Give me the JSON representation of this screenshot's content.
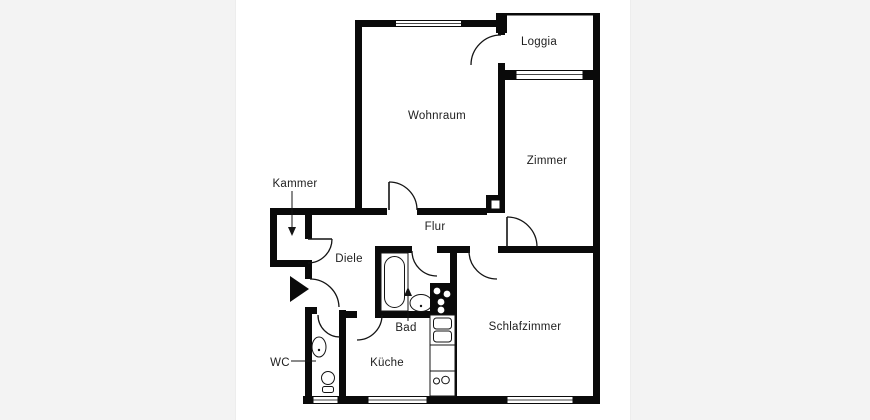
{
  "title": "Grundriss Wohnung (floor plan)",
  "colors": {
    "wall": "#0a0a0a",
    "canvas": "#ffffff",
    "side_panels": "#f3f3f3"
  },
  "rooms": [
    {
      "id": "loggia",
      "label": "Loggia"
    },
    {
      "id": "wohnraum",
      "label": "Wohnraum"
    },
    {
      "id": "zimmer",
      "label": "Zimmer"
    },
    {
      "id": "kammer",
      "label": "Kammer"
    },
    {
      "id": "flur",
      "label": "Flur"
    },
    {
      "id": "diele",
      "label": "Diele"
    },
    {
      "id": "bad",
      "label": "Bad"
    },
    {
      "id": "wc",
      "label": "WC"
    },
    {
      "id": "kueche",
      "label": "Küche"
    },
    {
      "id": "schlafzimmer",
      "label": "Schlafzimmer"
    }
  ],
  "icons": {
    "entrance_arrow": "apartment-entrance-marker",
    "bathtub": "bathtub",
    "stove": "stove-4-burners",
    "kitchen_sink": "double-sink-unit",
    "toilet": "toilet",
    "wash_basin": "wash-basin"
  }
}
